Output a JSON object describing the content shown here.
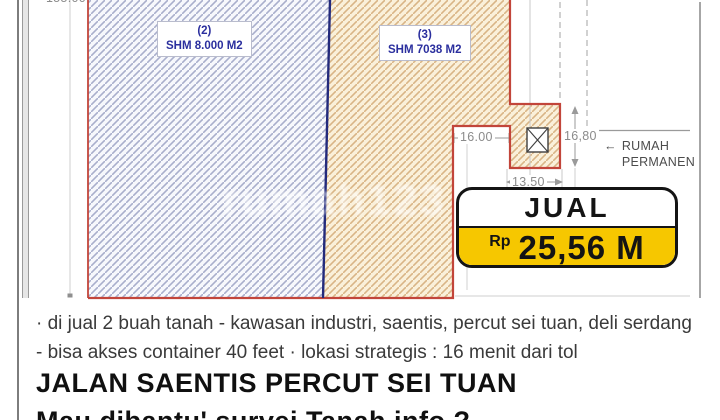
{
  "site_plan": {
    "parcels": [
      {
        "id": "(2)",
        "area": "SHM 8.000 M2"
      },
      {
        "id": "(3)",
        "area": "SHM 7038 M2"
      }
    ],
    "dimensions": {
      "left_height_cropped": "155.00",
      "notch_width": "16.00",
      "annex_height": "16,80",
      "annex_width": "13.50"
    },
    "neighbor_label": "RUMAH PERMANEN",
    "arrow_left": "←",
    "watermark": "rumah123"
  },
  "price_badge": {
    "action": "JUAL",
    "currency": "Rp",
    "amount": "25,56 M"
  },
  "listing": {
    "description": "· di jual 2 buah tanah - kawasan industri, saentis, percut sei tuan, deli serdang - bisa akses container 40 feet · lokasi strategis : 16 menit dari tol",
    "title": "JALAN SAENTIS PERCUT SEI TUAN",
    "subtitle_cropped": "Mau dibantu' survei Tanah info ?"
  },
  "colors": {
    "parcel2_hatch": "#a9afcc",
    "parcel2_border": "#232a7c",
    "parcel3_bg": "#faf0da",
    "parcel3_hatch": "#d9b586",
    "boundary_red": "#c2453a",
    "badge_yellow": "#f6c700",
    "label_navy": "#2b2f9e"
  }
}
